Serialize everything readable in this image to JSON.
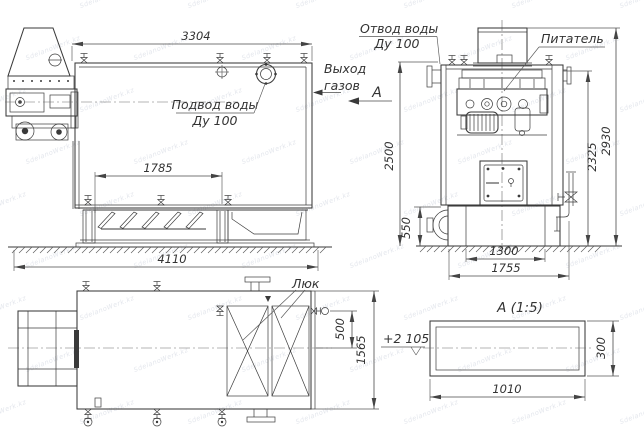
{
  "watermark": {
    "text": "SdelanoWerk.kz"
  },
  "side_view": {
    "dim_length_top": "3304",
    "dim_grate_length": "1785",
    "dim_overall_length": "4110",
    "water_supply_label": "Подвод воды",
    "water_supply_size": "Ду 100",
    "gas_outlet_line1": "Выход",
    "gas_outlet_line2": "газов",
    "section_mark": "А"
  },
  "front_view": {
    "water_outlet_label": "Отвод воды",
    "water_outlet_size": "Ду 100",
    "feeder_label": "Питатель",
    "dim_height_to_top": "2500",
    "dim_ground_clearance": "550",
    "dim_drum_body_length": "1300",
    "dim_drum_overall_length": "1755",
    "dim_body_height": "2325",
    "dim_overall_height": "2930"
  },
  "plan_view": {
    "hatch_label": "Люк",
    "dim_offset": "500",
    "dim_overall_width": "1565",
    "level_mark": "+2 105"
  },
  "detail_view": {
    "title": "А  (1:5)",
    "dim_length": "1010",
    "dim_height": "300"
  }
}
